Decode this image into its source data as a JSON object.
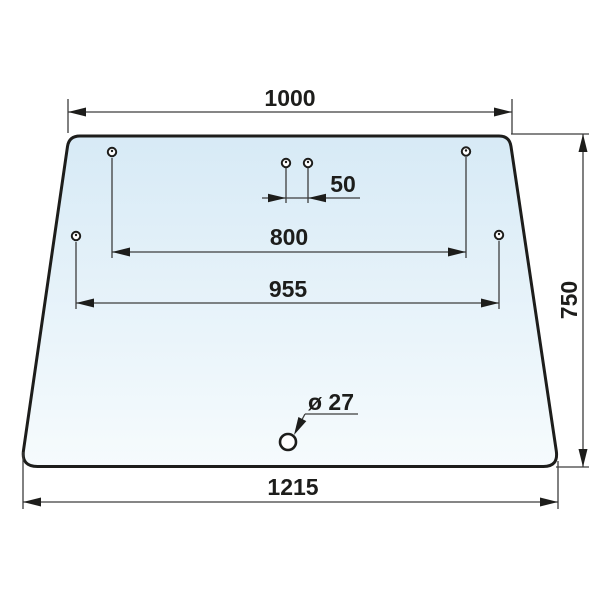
{
  "drawing": {
    "shape": "trapezoid-glass-panel",
    "dimensions": {
      "top_width": "1000",
      "hole_pair_spacing": "50",
      "upper_hole_spacing": "800",
      "mid_hole_spacing": "955",
      "height": "750",
      "bottom_width": "1215",
      "hole_diameter": "ø 27"
    },
    "colors": {
      "outline": "#1d1d1b",
      "dim_line": "#3d3d3d",
      "text_color": "#1d1d1b",
      "glass_top": "#d7eaf6",
      "glass_bottom": "#f6fbfd",
      "page_bg": "#ffffff"
    }
  }
}
